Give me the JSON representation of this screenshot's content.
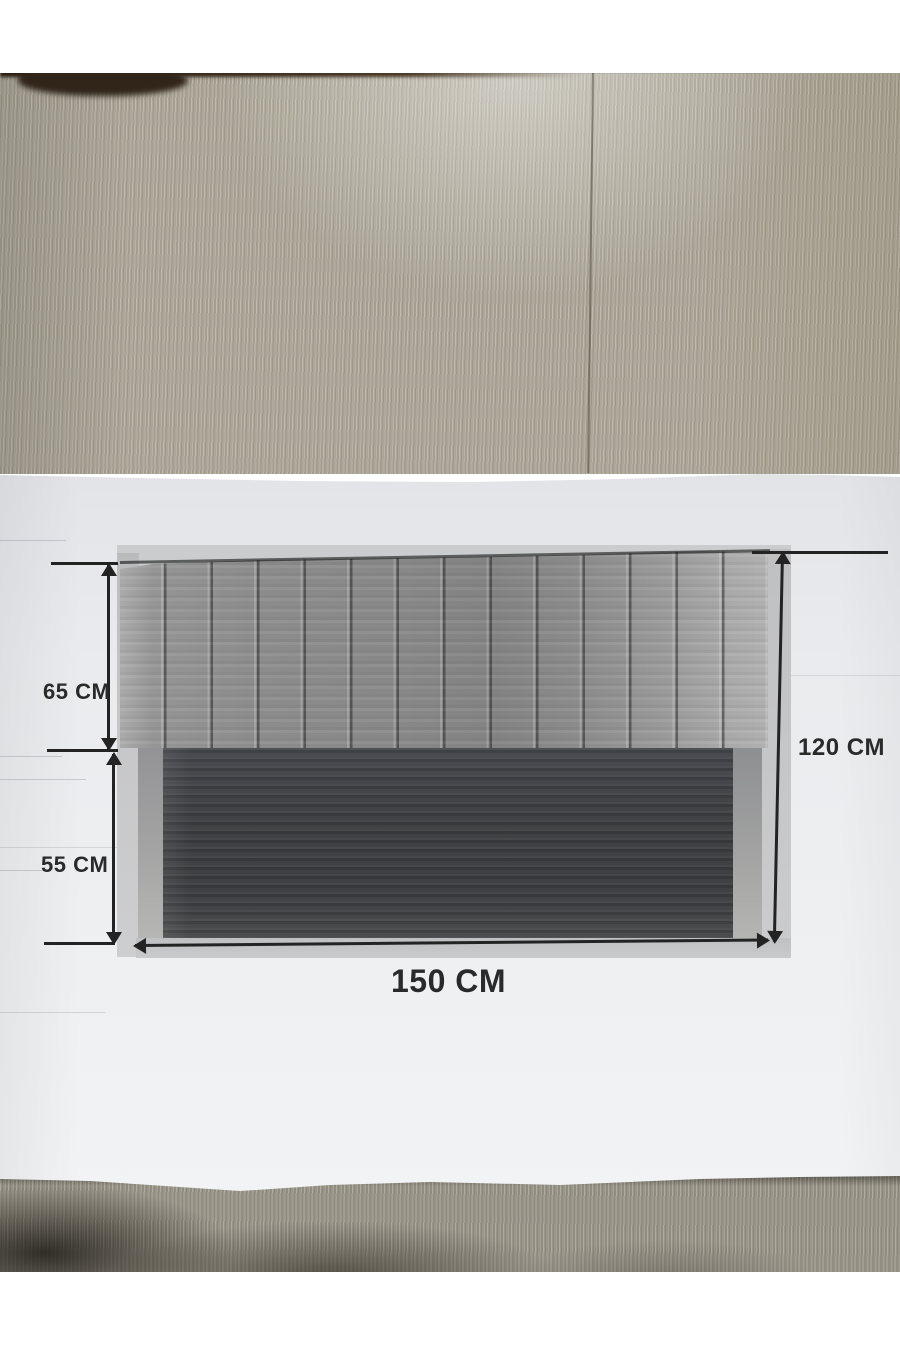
{
  "scene": {
    "dimension_labels": {
      "top_section_height": "65 CM",
      "bottom_section_height": "55 CM",
      "total_height": "120 CM",
      "total_width": "150 CM"
    },
    "colors": {
      "ink": "#232323",
      "paper": "#eceef0",
      "wood_floor": "#aca798",
      "floor_shadow": "#444033",
      "carpet_edge": "#31251a",
      "headboard_fabric": "#8f8f8f",
      "dark_base_panel": "#3e4043",
      "print_border": "#c7c8ca"
    },
    "print": {
      "pleat_count": 14
    }
  }
}
